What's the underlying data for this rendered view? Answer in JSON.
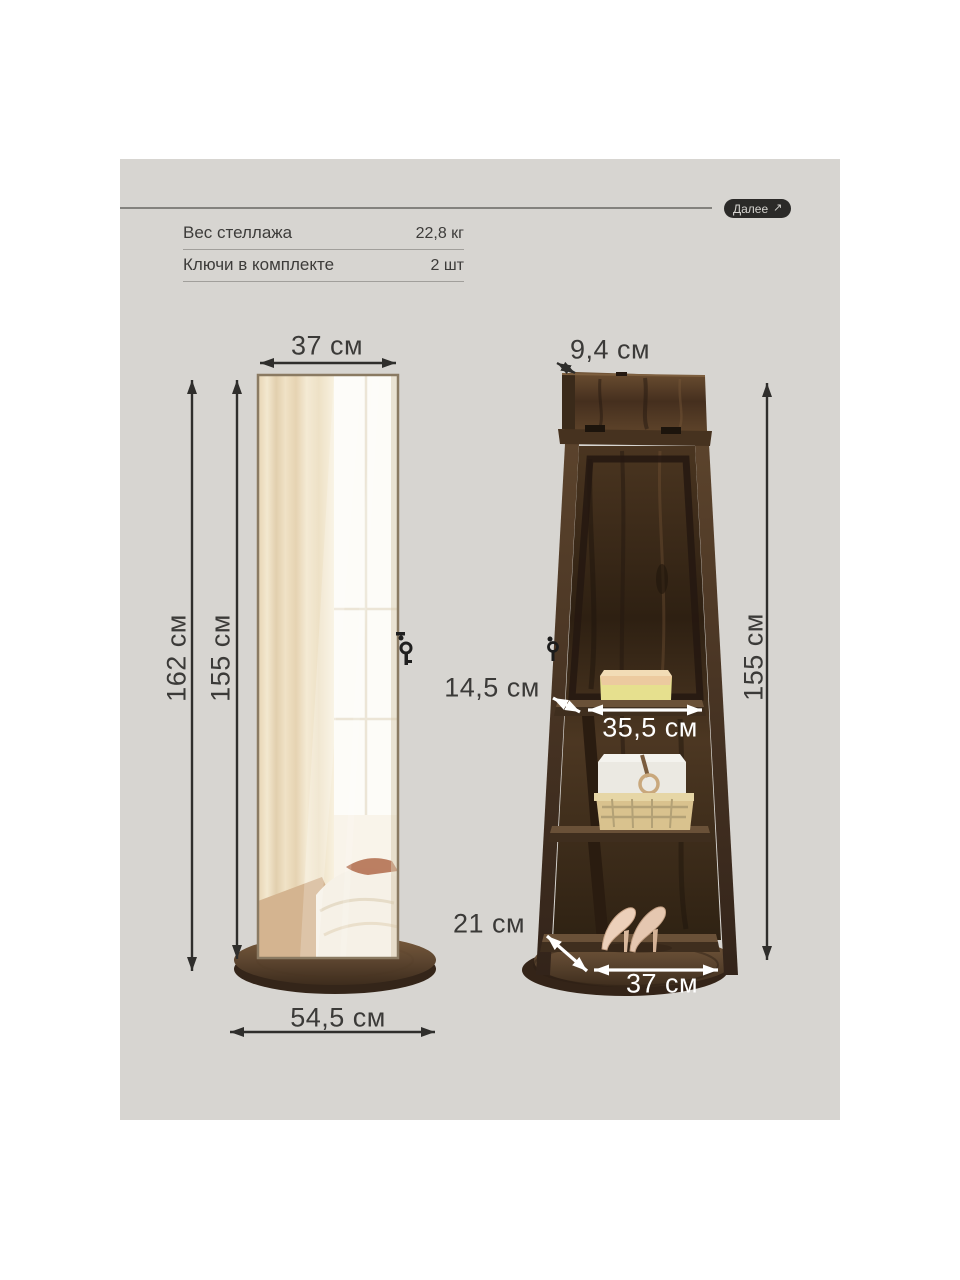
{
  "colors": {
    "page_bg": "#ffffff",
    "card_bg": "#d7d5d1",
    "text": "#3d3c3a",
    "button_bg": "#2b2a28",
    "button_text": "#d6d4d0",
    "dim_arrow_dark": "#2f2e2c",
    "dim_arrow_light": "#ffffff",
    "wood_dark": "#33241545",
    "wood_mid": "#4a3520"
  },
  "header": {
    "next_label": "Далее",
    "next_arrow_glyph": "↗"
  },
  "specs": [
    {
      "label": "Вес стеллажа",
      "value": "22,8 кг"
    },
    {
      "label": "Ключи в комплекте",
      "value": "2 шт"
    }
  ],
  "dimensions": {
    "front_width": "37 см",
    "front_height_total": "162 см",
    "front_height_mirror": "155 см",
    "front_base_width": "54,5 см",
    "back_top_depth": "9,4 см",
    "back_height": "155 см",
    "back_shelf_depth": "14,5 см",
    "back_shelf_width": "35,5 см",
    "back_base_depth": "21 см",
    "back_base_width": "37 см"
  }
}
